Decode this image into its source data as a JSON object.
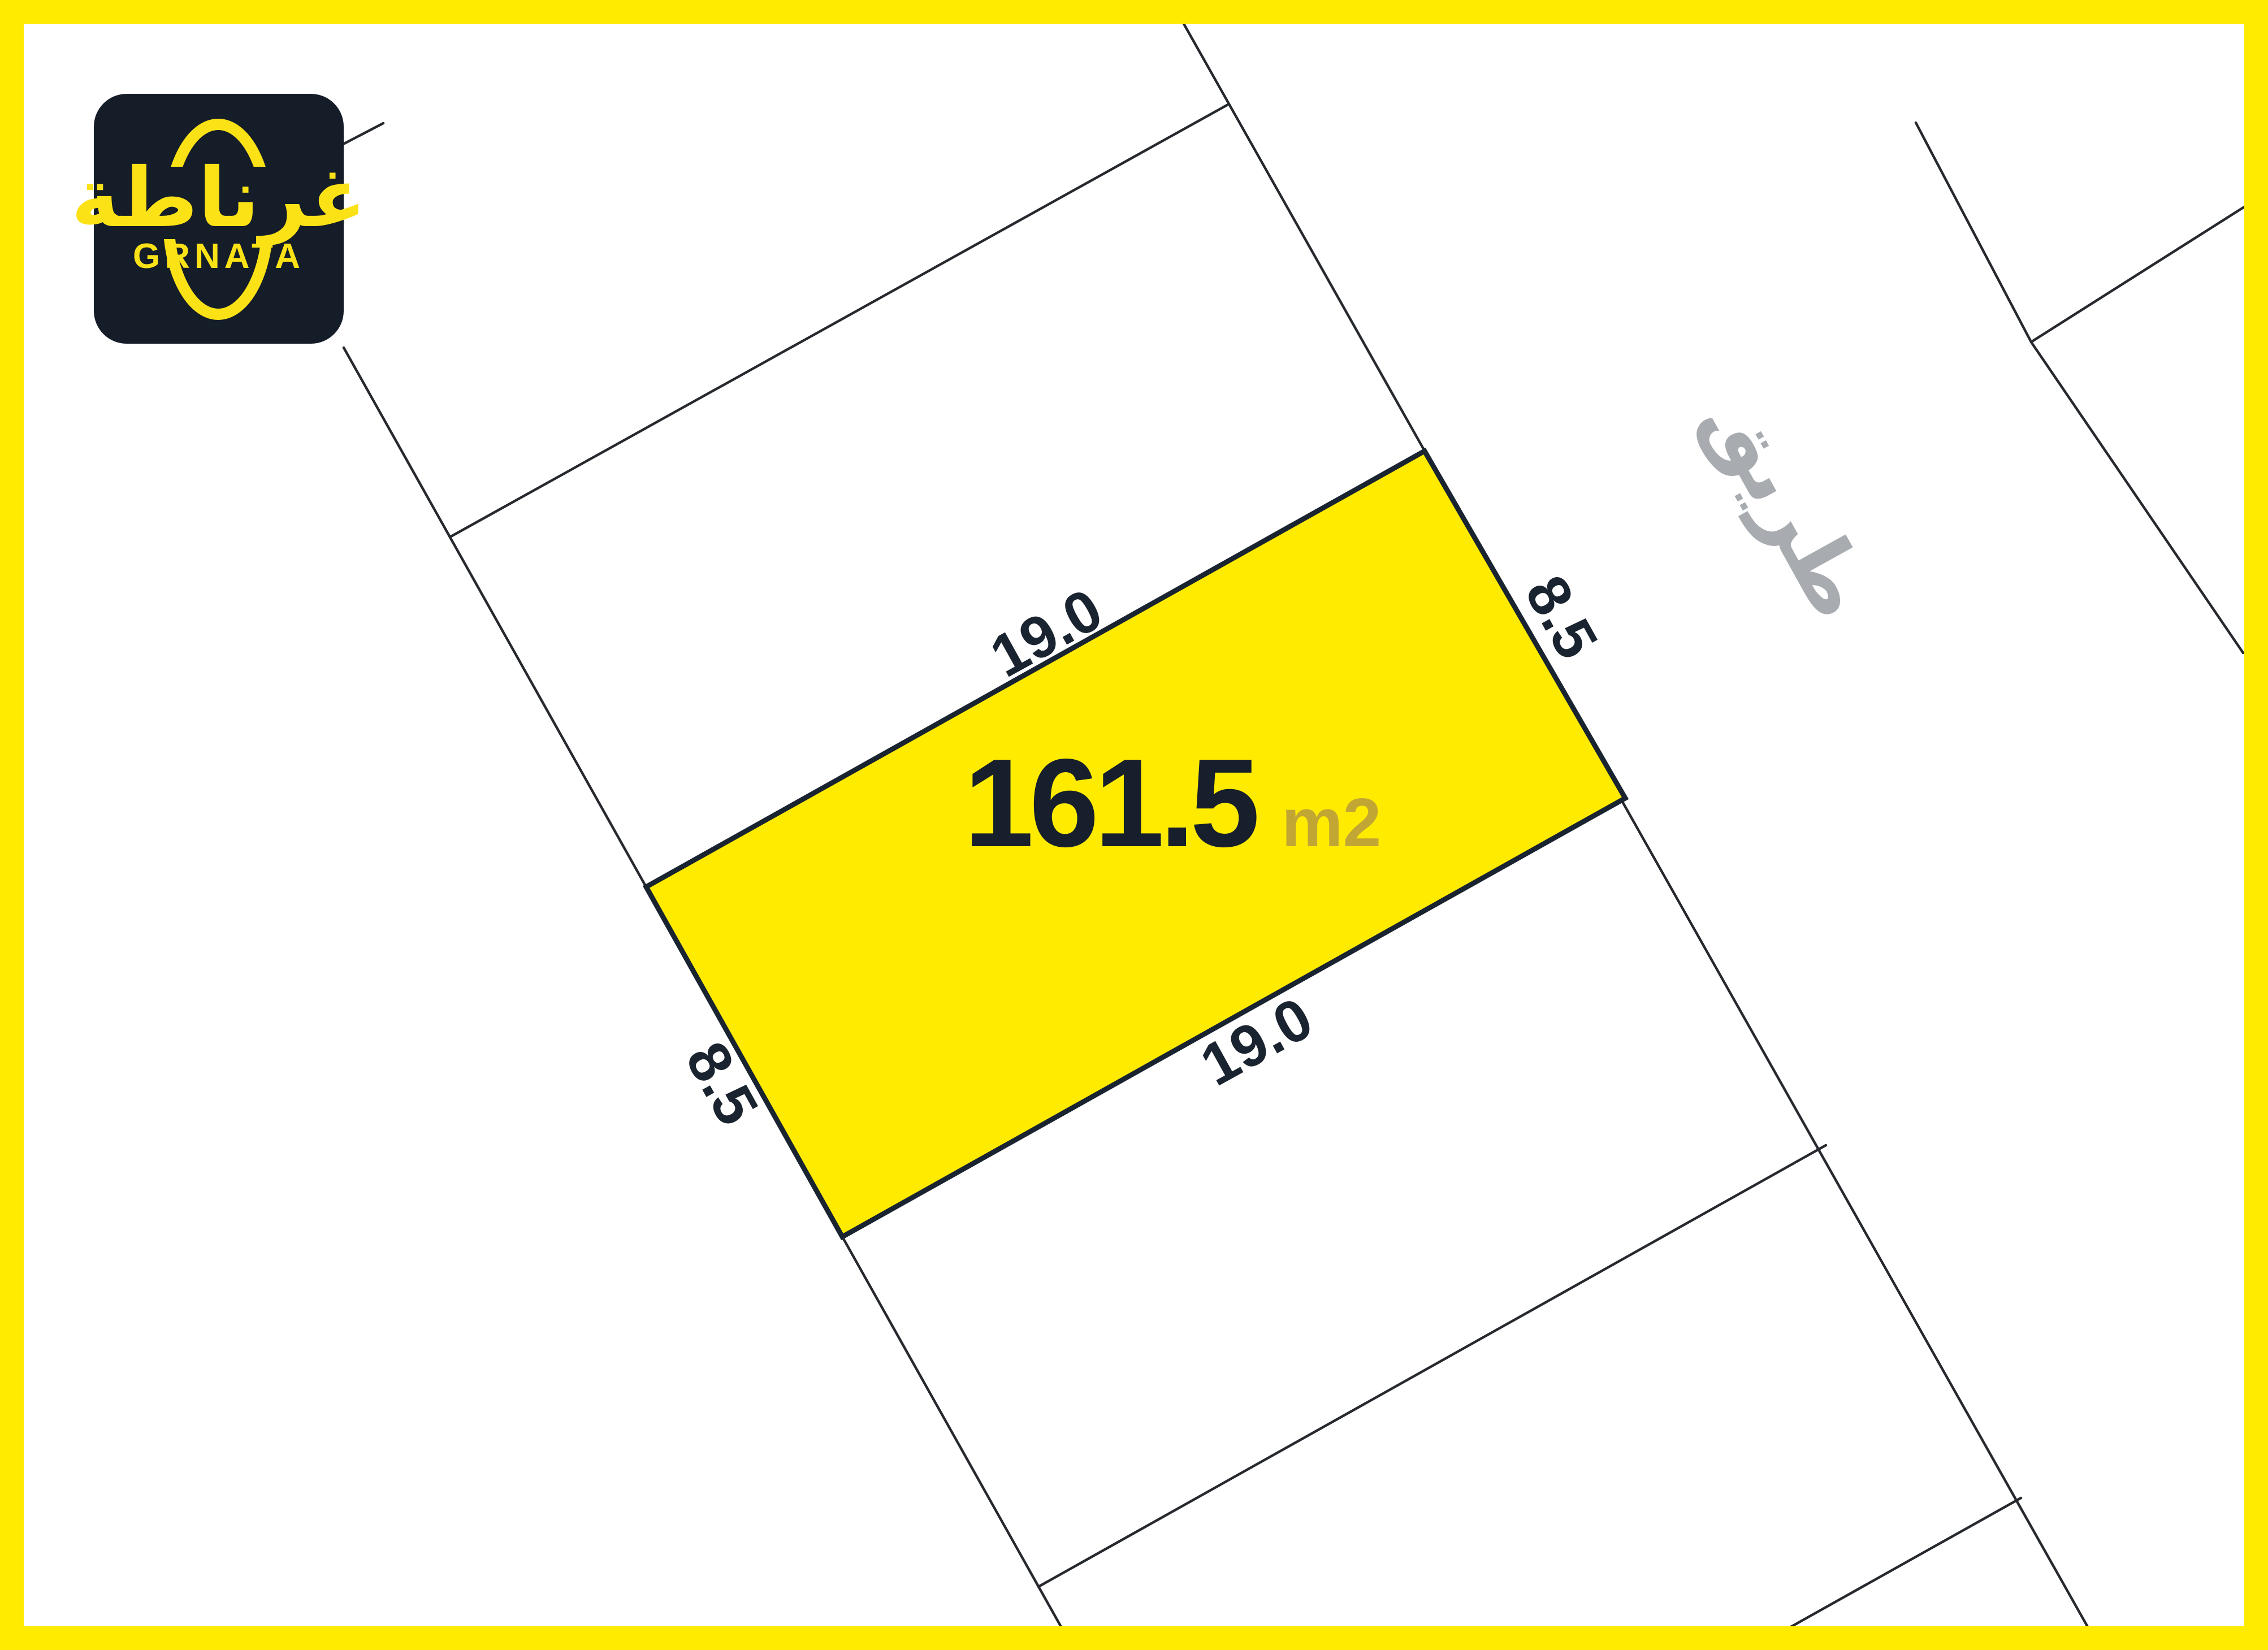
{
  "logo": {
    "arabic": "غرناطة",
    "latin": "GRNATA"
  },
  "parcel": {
    "area_value": "161.5",
    "area_unit": "m2",
    "dim_top": "19.0",
    "dim_bottom": "19.0",
    "dim_left": "8.5",
    "dim_right": "8.5"
  },
  "road": {
    "label": "طريق"
  },
  "colors": {
    "frame_yellow": "#FFEB00",
    "parcel_yellow": "#FFEB00",
    "outline_navy": "#1A2430",
    "line_dark": "#26292E",
    "area_navy": "#161F2B",
    "unit_gold": "#C2A634",
    "road_gray": "#A8ABAF",
    "logo_bg": "#141D28",
    "logo_yellow": "#FBE216"
  }
}
